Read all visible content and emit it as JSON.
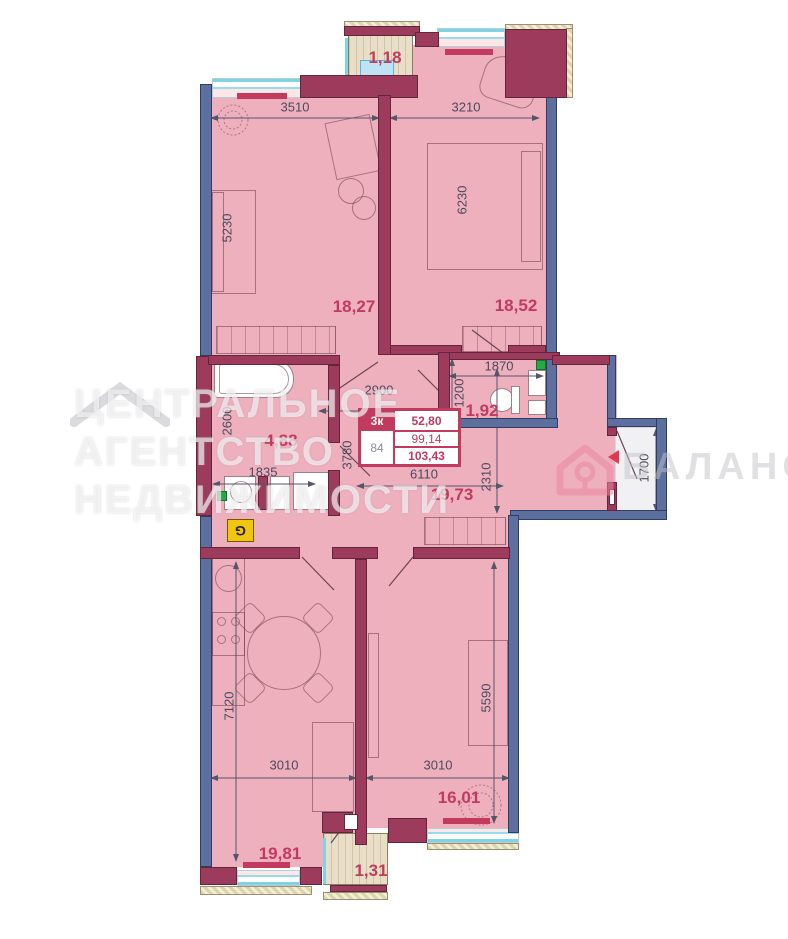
{
  "plan_title": "apartment-floor-plan",
  "areas": {
    "balcony_top": "1,18",
    "bedroom1": "18,27",
    "bedroom2": "18,52",
    "bathroom": "4,88",
    "wc": "1,92",
    "hall": "19,73",
    "kitchen_living": "19,81",
    "room3": "16,01",
    "balcony_bottom": "1,31"
  },
  "dims": {
    "bedroom1_width": "3510",
    "bedroom2_width": "3210",
    "bedroom1_depth": "5230",
    "bedroom2_depth": "6230",
    "hall_width_top": "2900",
    "wc_width": "1870",
    "wc_depth": "1200",
    "bath_depth": "2600",
    "bath_width": "1835",
    "hall_depth": "3780",
    "hall_width": "6110",
    "hall_right_depth": "2310",
    "entry_depth": "1700",
    "kitchen_depth": "7120",
    "kitchen_width": "3010",
    "room3_width": "3010",
    "room3_depth": "5590"
  },
  "stamp": {
    "type_label": "3к",
    "living_area": "52,80",
    "area": "99,14",
    "number": "84",
    "total_area": "103,43"
  },
  "markers": {
    "gas": "G"
  },
  "watermark": {
    "agency_line1": "ЦЕНТРАЛЬНОЕ",
    "agency_line2": "АГЕНТСТВО",
    "agency_line3": "НЕДВИЖИМОСТИ",
    "brand": "БАЛАНС"
  },
  "colors": {
    "room_fill": "#efb0be",
    "bearing_wall": "#5d6f9e",
    "partition_wall": "#9c3b5b",
    "accent_crimson": "#c23a5e",
    "window_glass": "#7fd3e6",
    "balcony_floor": "#e9dfc8",
    "gas_marker": "#f2c50f"
  }
}
